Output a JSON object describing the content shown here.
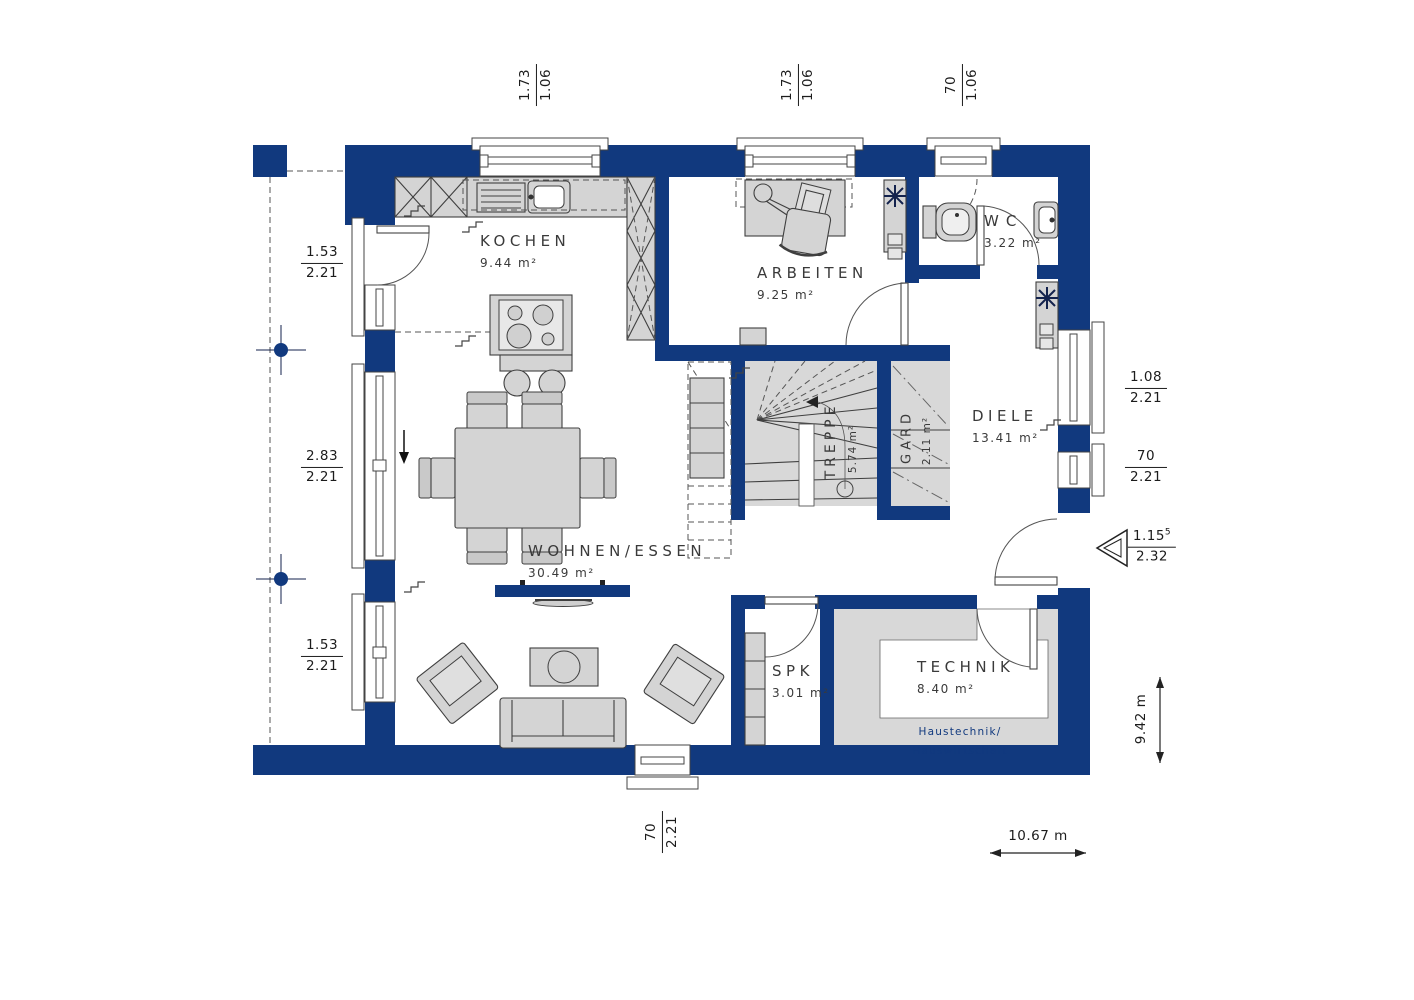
{
  "colors": {
    "wall": "#11397e",
    "furn": "#d4d4d4",
    "floor": "#d8d8d8"
  },
  "rooms": {
    "kochen": {
      "name": "KOCHEN",
      "area": "9.44 m²"
    },
    "arbeiten": {
      "name": "ARBEITEN",
      "area": "9.25 m²"
    },
    "wc": {
      "name": "WC",
      "area": "3.22 m²"
    },
    "diele": {
      "name": "DIELE",
      "area": "13.41 m²"
    },
    "treppe": {
      "name": "TREPPE",
      "area": "5.74 m²"
    },
    "gard": {
      "name": "GARD",
      "area": "2.11 m²"
    },
    "wohnen": {
      "name": "WOHNEN/ESSEN",
      "area": "30.49 m²"
    },
    "spk": {
      "name": "SPK",
      "area": "3.01 m²"
    },
    "technik": {
      "name": "TECHNIK",
      "area": "8.40 m²",
      "note1": "Haustechnik/",
      "note2": "Hauswirtschaft"
    }
  },
  "dims": {
    "top1": {
      "num": "1.73",
      "den": "1.06"
    },
    "top2": {
      "num": "1.73",
      "den": "1.06"
    },
    "top3": {
      "num": "70",
      "den": "1.06"
    },
    "left1": {
      "num": "1.53",
      "den": "2.21"
    },
    "left2": {
      "num": "2.83",
      "den": "2.21"
    },
    "left3": {
      "num": "1.53",
      "den": "2.21"
    },
    "right1": {
      "num": "1.08",
      "den": "2.21"
    },
    "right2": {
      "num": "70",
      "den": "2.21"
    },
    "right3": {
      "num": "1.15",
      "sup": "5",
      "den": "2.32"
    },
    "bottom1": {
      "num": "70",
      "den": "2.21"
    },
    "width": "10.67 m",
    "height": "9.42 m"
  }
}
